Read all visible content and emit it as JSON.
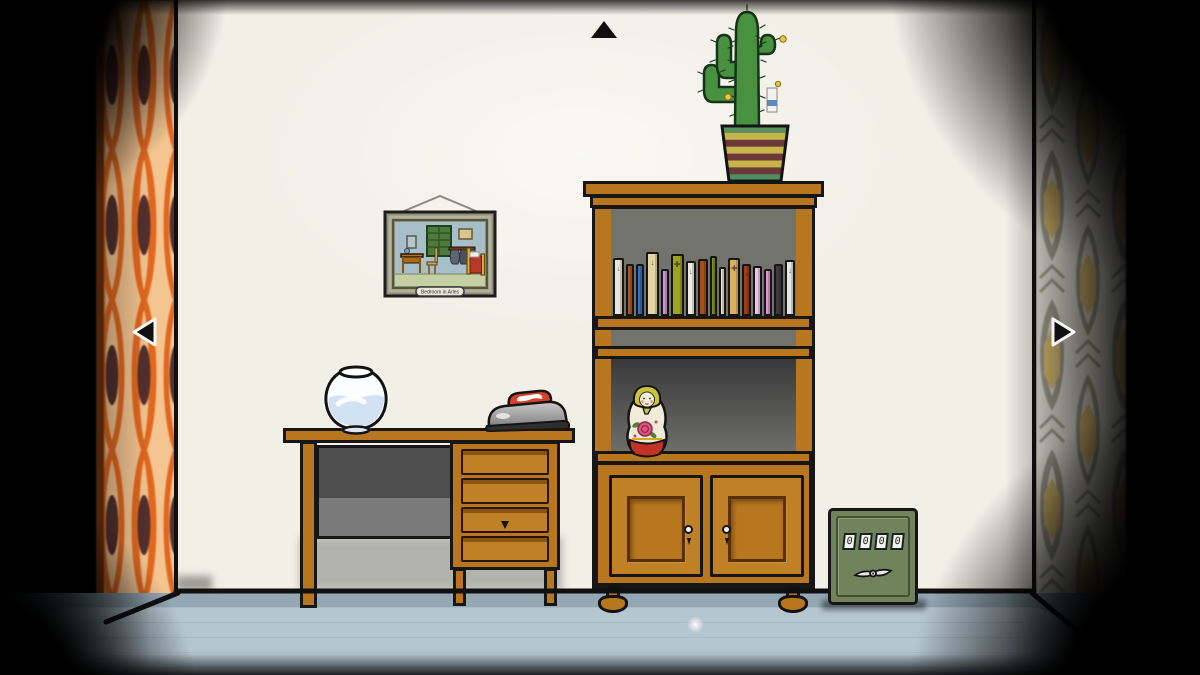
{
  "picture": {
    "plaque_label": "Bedroom in Arles"
  },
  "safe": {
    "dials": [
      "0",
      "0",
      "0",
      "0"
    ]
  },
  "navigation": {
    "up_icon": "black-triangle-up",
    "left_icon": "black-triangle-left-white-outline",
    "right_icon": "black-triangle-right-white-outline"
  },
  "bookshelf": {
    "books": [
      {
        "color": "#e9e6db",
        "width": 11,
        "height": 58,
        "glyph": "↓"
      },
      {
        "color": "#b0551f",
        "width": 8,
        "height": 52,
        "glyph": ""
      },
      {
        "color": "#3570c4",
        "width": 8,
        "height": 52,
        "glyph": ""
      },
      {
        "color": "#e4d5a5",
        "width": 13,
        "height": 64,
        "glyph": "↓"
      },
      {
        "color": "#d392d6",
        "width": 8,
        "height": 47,
        "glyph": ""
      },
      {
        "color": "#9aa41f",
        "width": 13,
        "height": 62,
        "glyph": "✚"
      },
      {
        "color": "#efeadf",
        "width": 10,
        "height": 55,
        "glyph": "↓"
      },
      {
        "color": "#a64e1c",
        "width": 11,
        "height": 57,
        "glyph": ""
      },
      {
        "color": "#7f9421",
        "width": 7,
        "height": 60,
        "glyph": ""
      },
      {
        "color": "#efe7d4",
        "width": 7,
        "height": 49,
        "glyph": ""
      },
      {
        "color": "#d9b15e",
        "width": 12,
        "height": 58,
        "glyph": "✚"
      },
      {
        "color": "#9c3f1a",
        "width": 9,
        "height": 52,
        "glyph": "▫"
      },
      {
        "color": "#eec3e8",
        "width": 9,
        "height": 50,
        "glyph": ""
      },
      {
        "color": "#e78fd0",
        "width": 8,
        "height": 47,
        "glyph": ""
      },
      {
        "color": "#3c3c3c",
        "width": 9,
        "height": 52,
        "glyph": ""
      },
      {
        "color": "#e6e6e3",
        "width": 10,
        "height": 56,
        "glyph": "↓"
      }
    ]
  },
  "cactus": {
    "pot_stripes": [
      "#58905e",
      "#c8b54a",
      "#6b3937",
      "#c8b54a",
      "#6b3937",
      "#c8b54a",
      "#6b3937",
      "#4f8f62"
    ]
  },
  "colors": {
    "wall": "#f1efe6",
    "floor": "#93a7b4",
    "floorLight": "#b6c6d1",
    "wood": "#b8761f",
    "woodDark": "#8a5413",
    "woodLight": "#c08026",
    "outline": "#161616",
    "safeBody": "#71835a",
    "safeTrim": "#3f4c30",
    "wpLeftBg": "#f4c591",
    "wpLeftAccent": "#e2671e",
    "wpLeftDark": "#53302e",
    "wpRightBg": "#edebe0",
    "wpRightLine": "#a6a695",
    "wpRightCenter": "#eac977",
    "ironRed": "#d7402b",
    "water": "#d3e2f3"
  }
}
